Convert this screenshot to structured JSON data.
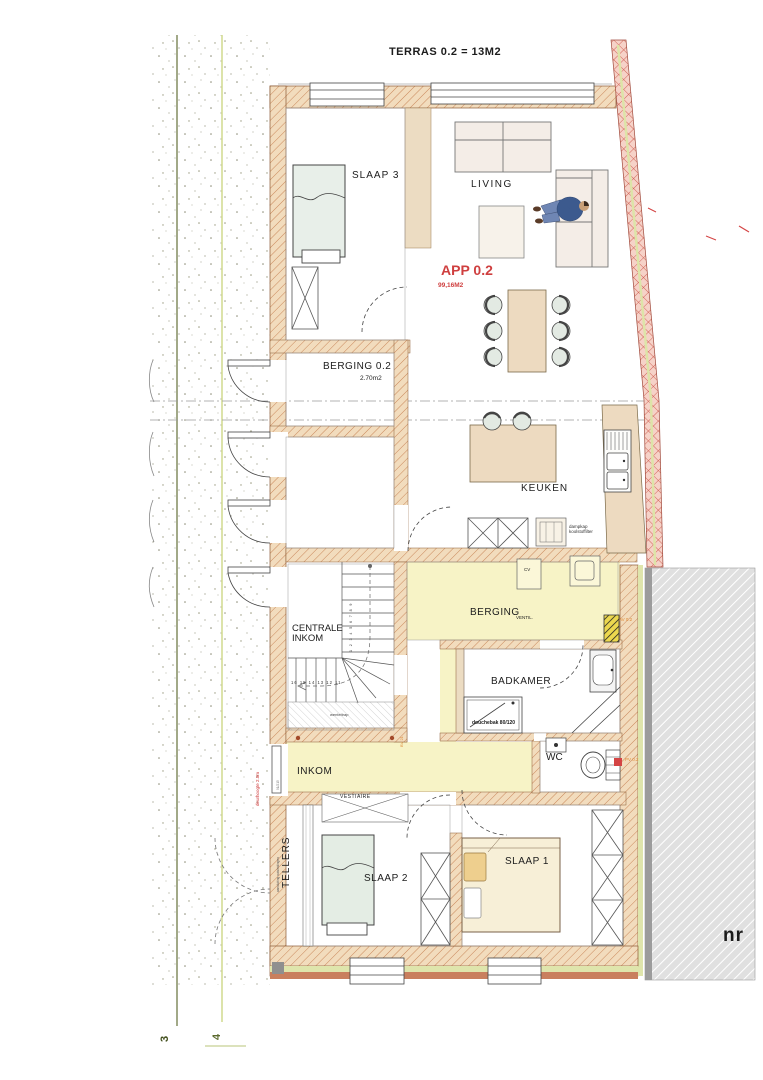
{
  "plan": {
    "terras_label": "TERRAS 0.2 =  13M2",
    "apartment": {
      "code": "APP 0.2",
      "area": "99,16M2"
    },
    "rooms": {
      "slaap3": "SLAAP 3",
      "living": "LIVING",
      "berging02": "BERGING 0.2",
      "berging02_area": "2.70m2",
      "keuken": "KEUKEN",
      "berging": "BERGING",
      "centrale_inkom": "CENTRALE INKOM",
      "badkamer": "BADKAMER",
      "wc": "WC",
      "inkom": "INKOM",
      "vestiaire": "VESTIAIRE",
      "tellers": "TELLERS",
      "slaap2": "SLAAP 2",
      "slaap1": "SLAAP 1"
    },
    "annotations": {
      "douchebak": "douchebak 80/120",
      "dampkap": "dampkap\nkoolstoffilter",
      "cv": "CV",
      "ventil": "VENTIL.",
      "stair_hatch": "wenteltrap",
      "stair_row_numbers": "16 15 14 13 12 11",
      "stair_side_numbers": "1 2 3 4 5 6 7 8 9",
      "tellers_note": "aansluiting nutsleidingen",
      "door_note": "deurhoogte 2.5m",
      "door_size": "91/215",
      "door_code": "BV 21",
      "duct_wc": "PV 0.2",
      "duct_berging": "AV 0.2",
      "neighbor_text": "nr"
    },
    "grid": {
      "line3": "3",
      "line4": "4"
    },
    "colors": {
      "accent_red": "#cf3f3f",
      "wall_tan": "#f2dcbd",
      "wall_hatch_line": "#c9875a",
      "red_wall": "#f6d2c8",
      "red_wall_line": "#cd5a4c",
      "yellow_zone": "#f7f3c6",
      "insulation": "#dfe5ac",
      "neighbor_gray": "#e0e0e0",
      "grid3_green": "#44511f",
      "grid4_green": "#ccd68c",
      "code_orange": "#dd8833"
    }
  }
}
